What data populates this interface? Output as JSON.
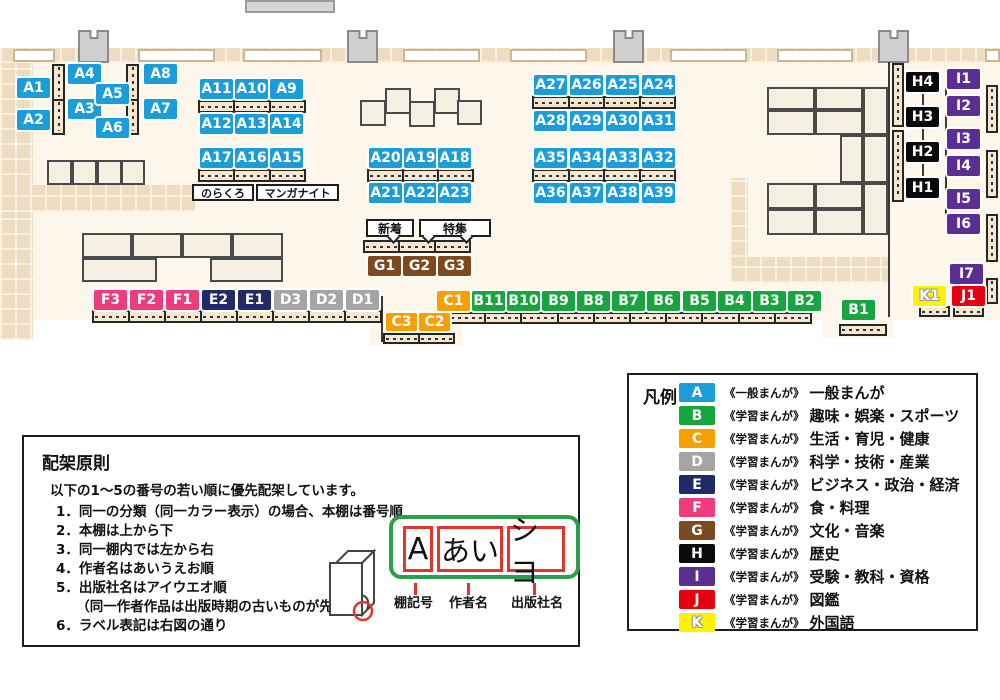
{
  "canvas": {
    "width": 1000,
    "height": 700
  },
  "map": {
    "label_size": {
      "w": 33,
      "h": 20
    },
    "labels": [
      {
        "text": "A1",
        "x": 17,
        "y": 78
      },
      {
        "text": "A2",
        "x": 17,
        "y": 110
      },
      {
        "text": "A4",
        "x": 68,
        "y": 64
      },
      {
        "text": "A3",
        "x": 68,
        "y": 99
      },
      {
        "text": "A5",
        "x": 96,
        "y": 84
      },
      {
        "text": "A6",
        "x": 96,
        "y": 118
      },
      {
        "text": "A8",
        "x": 144,
        "y": 64
      },
      {
        "text": "A7",
        "x": 144,
        "y": 99
      },
      {
        "text": "A11",
        "x": 200,
        "y": 79
      },
      {
        "text": "A10",
        "x": 235,
        "y": 79
      },
      {
        "text": "A9",
        "x": 270,
        "y": 79
      },
      {
        "text": "A12",
        "x": 200,
        "y": 114
      },
      {
        "text": "A13",
        "x": 235,
        "y": 114
      },
      {
        "text": "A14",
        "x": 270,
        "y": 114
      },
      {
        "text": "A17",
        "x": 200,
        "y": 148
      },
      {
        "text": "A16",
        "x": 235,
        "y": 148
      },
      {
        "text": "A15",
        "x": 270,
        "y": 148
      },
      {
        "text": "A20",
        "x": 369,
        "y": 148
      },
      {
        "text": "A19",
        "x": 404,
        "y": 148
      },
      {
        "text": "A18",
        "x": 438,
        "y": 148
      },
      {
        "text": "A21",
        "x": 369,
        "y": 183
      },
      {
        "text": "A22",
        "x": 404,
        "y": 183
      },
      {
        "text": "A23",
        "x": 438,
        "y": 183
      },
      {
        "text": "A27",
        "x": 534,
        "y": 75
      },
      {
        "text": "A26",
        "x": 570,
        "y": 75
      },
      {
        "text": "A25",
        "x": 606,
        "y": 75
      },
      {
        "text": "A24",
        "x": 642,
        "y": 75
      },
      {
        "text": "A28",
        "x": 534,
        "y": 111
      },
      {
        "text": "A29",
        "x": 570,
        "y": 111
      },
      {
        "text": "A30",
        "x": 606,
        "y": 111
      },
      {
        "text": "A31",
        "x": 642,
        "y": 111
      },
      {
        "text": "A35",
        "x": 534,
        "y": 148
      },
      {
        "text": "A34",
        "x": 570,
        "y": 148
      },
      {
        "text": "A33",
        "x": 606,
        "y": 148
      },
      {
        "text": "A32",
        "x": 642,
        "y": 148
      },
      {
        "text": "A36",
        "x": 534,
        "y": 183
      },
      {
        "text": "A37",
        "x": 570,
        "y": 183
      },
      {
        "text": "A38",
        "x": 606,
        "y": 183
      },
      {
        "text": "A39",
        "x": 642,
        "y": 183
      },
      {
        "text": "G1",
        "x": 368,
        "y": 256
      },
      {
        "text": "G2",
        "x": 403,
        "y": 256
      },
      {
        "text": "G3",
        "x": 438,
        "y": 256
      },
      {
        "text": "F3",
        "x": 94,
        "y": 290
      },
      {
        "text": "F2",
        "x": 130,
        "y": 290
      },
      {
        "text": "F1",
        "x": 166,
        "y": 290
      },
      {
        "text": "E2",
        "x": 202,
        "y": 290
      },
      {
        "text": "E1",
        "x": 238,
        "y": 290
      },
      {
        "text": "D3",
        "x": 274,
        "y": 290
      },
      {
        "text": "D2",
        "x": 310,
        "y": 290
      },
      {
        "text": "D1",
        "x": 346,
        "y": 290
      },
      {
        "text": "C1",
        "x": 437,
        "y": 291
      },
      {
        "text": "B11",
        "x": 472,
        "y": 291
      },
      {
        "text": "B10",
        "x": 507,
        "y": 291
      },
      {
        "text": "B9",
        "x": 542,
        "y": 291
      },
      {
        "text": "B8",
        "x": 577,
        "y": 291
      },
      {
        "text": "B7",
        "x": 612,
        "y": 291
      },
      {
        "text": "B6",
        "x": 647,
        "y": 291
      },
      {
        "text": "B5",
        "x": 683,
        "y": 291
      },
      {
        "text": "B4",
        "x": 718,
        "y": 291
      },
      {
        "text": "B3",
        "x": 753,
        "y": 291
      },
      {
        "text": "B2",
        "x": 788,
        "y": 291
      },
      {
        "text": "C3",
        "x": 386,
        "y": 313,
        "w": 31,
        "h": 18
      },
      {
        "text": "C2",
        "x": 419,
        "y": 313,
        "w": 31,
        "h": 18
      },
      {
        "text": "B1",
        "x": 842,
        "y": 300
      },
      {
        "text": "K1",
        "x": 913,
        "y": 286
      },
      {
        "text": "J1",
        "x": 952,
        "y": 286
      },
      {
        "text": "I7",
        "x": 950,
        "y": 264
      },
      {
        "text": "H4",
        "x": 906,
        "y": 72
      },
      {
        "text": "H3",
        "x": 906,
        "y": 107
      },
      {
        "text": "H2",
        "x": 906,
        "y": 142
      },
      {
        "text": "H1",
        "x": 906,
        "y": 178
      },
      {
        "text": "I1",
        "x": 947,
        "y": 69
      },
      {
        "text": "I2",
        "x": 947,
        "y": 96
      },
      {
        "text": "I3",
        "x": 947,
        "y": 129
      },
      {
        "text": "I4",
        "x": 947,
        "y": 156
      },
      {
        "text": "I5",
        "x": 947,
        "y": 189
      },
      {
        "text": "I6",
        "x": 947,
        "y": 214
      }
    ],
    "small_labels": [
      {
        "text": "のらくろ",
        "x": 192,
        "y": 184,
        "w": 62,
        "h": 17,
        "fs": 11
      },
      {
        "text": "マンガナイト",
        "x": 256,
        "y": 184,
        "w": 83,
        "h": 17,
        "fs": 11
      }
    ],
    "callouts": [
      {
        "text": "新着",
        "x": 366,
        "y": 219,
        "w": 48,
        "h": 18,
        "fs": 12,
        "tails": [
          389
        ]
      },
      {
        "text": "特集",
        "x": 419,
        "y": 219,
        "w": 72,
        "h": 18,
        "fs": 12,
        "tails": [
          424,
          462
        ]
      }
    ],
    "shelves_h": [
      {
        "x": 198,
        "y": 100,
        "w": 108,
        "h": 13,
        "segs": 3
      },
      {
        "x": 198,
        "y": 169,
        "w": 108,
        "h": 13,
        "segs": 3
      },
      {
        "x": 367,
        "y": 169,
        "w": 107,
        "h": 13,
        "segs": 3
      },
      {
        "x": 532,
        "y": 96,
        "w": 144,
        "h": 13,
        "segs": 4
      },
      {
        "x": 532,
        "y": 169,
        "w": 144,
        "h": 13,
        "segs": 4
      },
      {
        "x": 363,
        "y": 240,
        "w": 108,
        "h": 13,
        "segs": 3
      },
      {
        "x": 92,
        "y": 310,
        "w": 290,
        "h": 13,
        "segs": 8
      },
      {
        "x": 448,
        "y": 312,
        "w": 364,
        "h": 12,
        "segs": 10
      },
      {
        "x": 383,
        "y": 333,
        "w": 72,
        "h": 11,
        "segs": 2
      },
      {
        "x": 839,
        "y": 324,
        "w": 48,
        "h": 12,
        "segs": 1
      },
      {
        "x": 919,
        "y": 306,
        "w": 31,
        "h": 11,
        "segs": 1
      },
      {
        "x": 953,
        "y": 306,
        "w": 31,
        "h": 11,
        "segs": 1
      }
    ],
    "shelves_v": [
      {
        "x": 52,
        "y": 64,
        "w": 13,
        "h": 71,
        "segs": 2
      },
      {
        "x": 126,
        "y": 64,
        "w": 13,
        "h": 71,
        "segs": 2
      },
      {
        "x": 892,
        "y": 63,
        "w": 12,
        "h": 64,
        "segs": 1
      },
      {
        "x": 892,
        "y": 130,
        "w": 12,
        "h": 72,
        "segs": 1
      },
      {
        "x": 986,
        "y": 85,
        "w": 12,
        "h": 48,
        "segs": 1
      },
      {
        "x": 986,
        "y": 150,
        "w": 12,
        "h": 48,
        "segs": 1
      },
      {
        "x": 986,
        "y": 214,
        "w": 12,
        "h": 48,
        "segs": 1
      },
      {
        "x": 986,
        "y": 278,
        "w": 12,
        "h": 26,
        "segs": 1
      }
    ],
    "tables": [
      {
        "x": 47,
        "y": 160,
        "w": 25,
        "h": 25
      },
      {
        "x": 72,
        "y": 160,
        "w": 25,
        "h": 25
      },
      {
        "x": 97,
        "y": 160,
        "w": 25,
        "h": 25
      },
      {
        "x": 121,
        "y": 160,
        "w": 24,
        "h": 25
      },
      {
        "x": 360,
        "y": 100,
        "w": 26,
        "h": 26
      },
      {
        "x": 385,
        "y": 88,
        "w": 26,
        "h": 26
      },
      {
        "x": 409,
        "y": 101,
        "w": 26,
        "h": 26
      },
      {
        "x": 434,
        "y": 88,
        "w": 26,
        "h": 26
      },
      {
        "x": 457,
        "y": 100,
        "w": 25,
        "h": 25
      },
      {
        "x": 82,
        "y": 233,
        "w": 50,
        "h": 25
      },
      {
        "x": 132,
        "y": 233,
        "w": 50,
        "h": 25
      },
      {
        "x": 182,
        "y": 233,
        "w": 50,
        "h": 25
      },
      {
        "x": 232,
        "y": 233,
        "w": 51,
        "h": 25
      },
      {
        "x": 82,
        "y": 258,
        "w": 75,
        "h": 24
      },
      {
        "x": 210,
        "y": 258,
        "w": 73,
        "h": 24
      },
      {
        "x": 767,
        "y": 87,
        "w": 48,
        "h": 23
      },
      {
        "x": 815,
        "y": 87,
        "w": 48,
        "h": 23
      },
      {
        "x": 863,
        "y": 87,
        "w": 25,
        "h": 48
      },
      {
        "x": 767,
        "y": 110,
        "w": 48,
        "h": 25
      },
      {
        "x": 815,
        "y": 110,
        "w": 48,
        "h": 25
      },
      {
        "x": 840,
        "y": 135,
        "w": 23,
        "h": 48
      },
      {
        "x": 863,
        "y": 135,
        "w": 25,
        "h": 48
      },
      {
        "x": 767,
        "y": 183,
        "w": 48,
        "h": 26
      },
      {
        "x": 815,
        "y": 183,
        "w": 48,
        "h": 26
      },
      {
        "x": 863,
        "y": 183,
        "w": 25,
        "h": 52
      },
      {
        "x": 767,
        "y": 209,
        "w": 48,
        "h": 26
      },
      {
        "x": 815,
        "y": 209,
        "w": 48,
        "h": 26
      }
    ],
    "pillars": [
      {
        "x": 78,
        "y": 30,
        "w": 31,
        "h": 33
      },
      {
        "x": 347,
        "y": 30,
        "w": 31,
        "h": 33
      },
      {
        "x": 613,
        "y": 30,
        "w": 31,
        "h": 33
      },
      {
        "x": 878,
        "y": 30,
        "w": 31,
        "h": 33
      }
    ],
    "windows": [
      {
        "x": 13,
        "y": 49,
        "w": 42,
        "h": 13
      },
      {
        "x": 138,
        "y": 49,
        "w": 77,
        "h": 13
      },
      {
        "x": 243,
        "y": 49,
        "w": 79,
        "h": 13
      },
      {
        "x": 403,
        "y": 49,
        "w": 77,
        "h": 13
      },
      {
        "x": 510,
        "y": 49,
        "w": 77,
        "h": 13
      },
      {
        "x": 670,
        "y": 49,
        "w": 77,
        "h": 13
      },
      {
        "x": 777,
        "y": 49,
        "w": 76,
        "h": 13
      },
      {
        "x": 985,
        "y": 49,
        "w": 15,
        "h": 13
      }
    ],
    "floor": [
      {
        "x": 0,
        "y": 48,
        "w": 1000,
        "h": 272
      },
      {
        "x": 370,
        "y": 318,
        "w": 92,
        "h": 28
      },
      {
        "x": 823,
        "y": 318,
        "w": 70,
        "h": 20
      }
    ],
    "checker": [
      {
        "x": 0,
        "y": 48,
        "w": 1000,
        "h": 15
      },
      {
        "x": 0,
        "y": 63,
        "w": 33,
        "h": 277
      },
      {
        "x": 0,
        "y": 185,
        "w": 195,
        "h": 27
      },
      {
        "x": 730,
        "y": 178,
        "w": 18,
        "h": 79
      },
      {
        "x": 730,
        "y": 257,
        "w": 158,
        "h": 26
      }
    ],
    "lines": [
      {
        "x": 888,
        "y": 62,
        "w": 2,
        "h": 255
      },
      {
        "x": 922,
        "y": 82,
        "w": 2,
        "h": 116
      },
      {
        "x": 945,
        "y": 82,
        "w": 2,
        "h": 150
      },
      {
        "x": 381,
        "y": 296,
        "w": 2,
        "h": 46
      }
    ],
    "grayrects": [
      {
        "x": 245,
        "y": 0,
        "w": 90,
        "h": 13
      }
    ]
  },
  "legend": {
    "title": "凡例",
    "items": [
      {
        "letter": "A",
        "color": "#1B9DD9",
        "series": "《一般まんが》",
        "category": "一般まんが"
      },
      {
        "letter": "B",
        "color": "#17A63E",
        "series": "《学習まんが》",
        "category": "趣味・娯楽・スポーツ"
      },
      {
        "letter": "C",
        "color": "#F6A000",
        "series": "《学習まんが》",
        "category": "生活・育児・健康"
      },
      {
        "letter": "D",
        "color": "#A5A5A5",
        "series": "《学習まんが》",
        "category": "科学・技術・産業"
      },
      {
        "letter": "E",
        "color": "#1F2A66",
        "series": "《学習まんが》",
        "category": "ビジネス・政治・経済"
      },
      {
        "letter": "F",
        "color": "#EE3D7C",
        "series": "《学習まんが》",
        "category": "食・料理"
      },
      {
        "letter": "G",
        "color": "#7B4A21",
        "series": "《学習まんが》",
        "category": "文化・音楽"
      },
      {
        "letter": "H",
        "color": "#0A0A0A",
        "series": "《学習まんが》",
        "category": "歴史"
      },
      {
        "letter": "I",
        "color": "#5B2E91",
        "series": "《学習まんが》",
        "category": "受験・教科・資格"
      },
      {
        "letter": "J",
        "color": "#E60012",
        "series": "《学習まんが》",
        "category": "図鑑"
      },
      {
        "letter": "K",
        "color": "#FFF100",
        "series": "《学習まんが》",
        "category": "外国語"
      }
    ]
  },
  "principles": {
    "title": "配架原則",
    "intro": "以下の1～5の番号の若い順に優先配架しています。",
    "items": [
      "1．同一の分類（同一カラー表示）の場合、本棚は番号順",
      "2．本棚は上から下",
      "3．同一棚内では左から右",
      "4．作者名はあいうえお順",
      "5．出版社名はアイウエオ順\n　　（同一作者作品は出版時期の古いものが先）",
      "6．ラベル表記は右図の通り"
    ]
  },
  "label_diagram": {
    "boxes": [
      "A",
      "あい",
      "シヨ"
    ],
    "captions": [
      "棚記号",
      "作者名",
      "出版社名"
    ]
  }
}
